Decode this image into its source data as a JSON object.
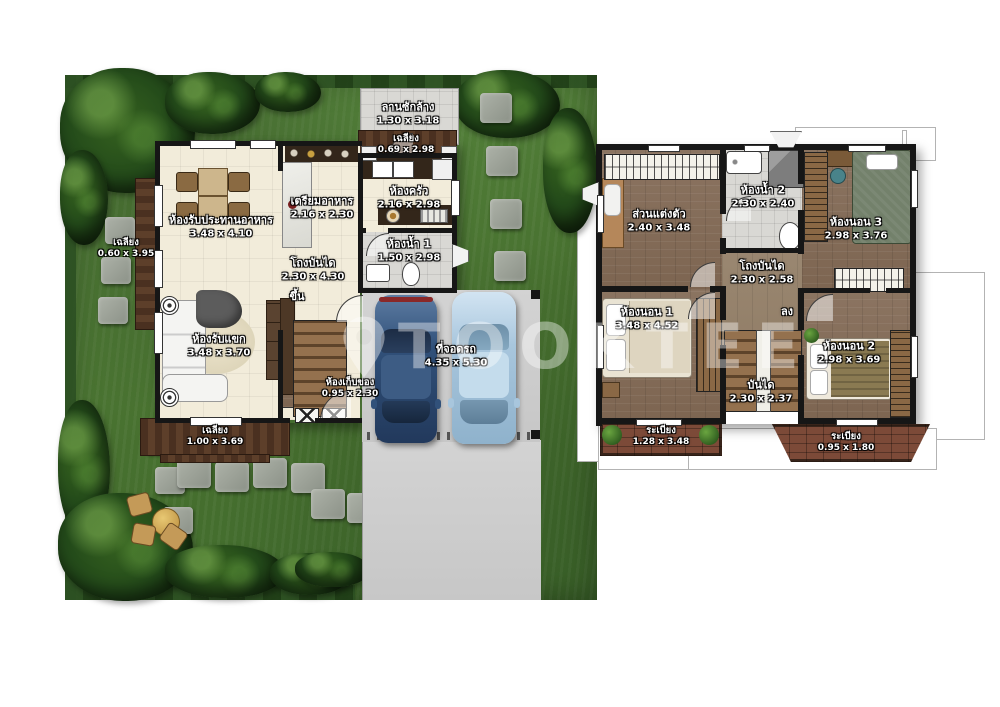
{
  "palette": {
    "grass": "#47702f",
    "deck_wood": "#5d3f2a",
    "floor_cream": "#f2ecda",
    "floor_wood": "#8b7461",
    "balcony_brick": "#7c4a38",
    "wall": "#161616",
    "car_dark": "#31517a",
    "car_light": "#b8d4e8"
  },
  "watermark": {
    "text": "TOOKTEE"
  },
  "ground": {
    "rooms": [
      {
        "key": "laundry-yard",
        "name": "ลานซักล้าง",
        "dims": "1.30 x 3.18"
      },
      {
        "key": "porch-top",
        "name": "เฉลียง",
        "dims": "0.69 x 2.98"
      },
      {
        "key": "kitchen",
        "name": "ห้องครัว",
        "dims": "2.16 x 2.98"
      },
      {
        "key": "pantry",
        "name": "เตรียมอาหาร",
        "dims": "2.16 x 2.30"
      },
      {
        "key": "dining",
        "name": "ห้องรับประทานอาหาร",
        "dims": "3.48 x 4.10"
      },
      {
        "key": "porch-left",
        "name": "เฉลียง",
        "dims": "0.60 x 3.95"
      },
      {
        "key": "bath-1",
        "name": "ห้องน้ำ 1",
        "dims": "1.50 x 2.98"
      },
      {
        "key": "stair-hall",
        "name": "โถงบันได",
        "dims": "2.30 x 4.30"
      },
      {
        "key": "up",
        "name": "ขึ้น",
        "dims": ""
      },
      {
        "key": "living",
        "name": "ห้องรับแขก",
        "dims": "3.48 x 3.70"
      },
      {
        "key": "storage",
        "name": "ห้องเก็บของ",
        "dims": "0.95 x 2.30"
      },
      {
        "key": "carport",
        "name": "ที่จอดรถ",
        "dims": "4.35 x 5.30"
      },
      {
        "key": "porch-bottom",
        "name": "เฉลียง",
        "dims": "1.00 x 3.69"
      }
    ]
  },
  "upper": {
    "rooms": [
      {
        "key": "dressing",
        "name": "ส่วนแต่งตัว",
        "dims": "2.40 x 3.48"
      },
      {
        "key": "bath-2",
        "name": "ห้องน้ำ 2",
        "dims": "2.30 x 2.40"
      },
      {
        "key": "bedroom-3",
        "name": "ห้องนอน 3",
        "dims": "2.98 x 3.76"
      },
      {
        "key": "stair-hall-2",
        "name": "โถงบันได",
        "dims": "2.30 x 2.58"
      },
      {
        "key": "bedroom-1",
        "name": "ห้องนอน 1",
        "dims": "3.48 x 4.52"
      },
      {
        "key": "down",
        "name": "ลง",
        "dims": ""
      },
      {
        "key": "stairs",
        "name": "บันได",
        "dims": "2.30 x 2.37"
      },
      {
        "key": "bedroom-2",
        "name": "ห้องนอน 2",
        "dims": "2.98 x 3.69"
      },
      {
        "key": "balcony-1",
        "name": "ระเบียง",
        "dims": "1.28 x 3.48"
      },
      {
        "key": "balcony-2",
        "name": "ระเบียง",
        "dims": "0.95 x 1.80"
      }
    ]
  }
}
